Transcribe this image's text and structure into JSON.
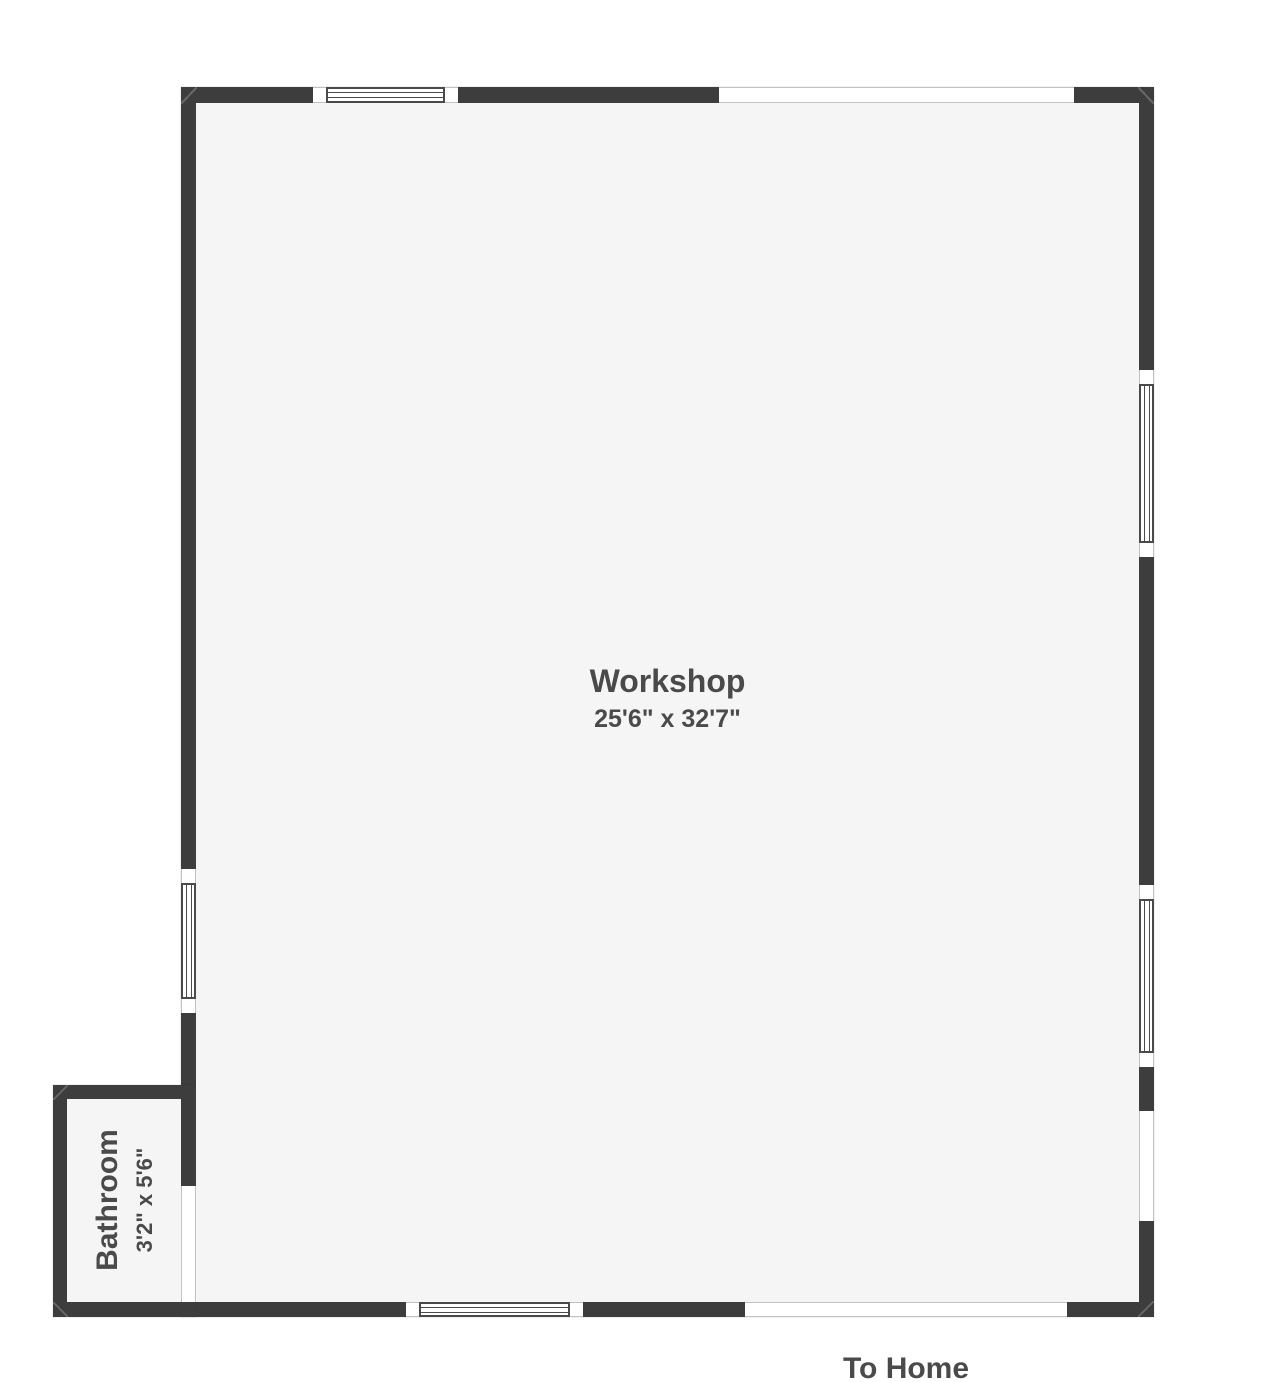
{
  "rooms": [
    {
      "name": "Workshop",
      "dimensions": "25'6\" x 32'7\""
    },
    {
      "name": "Bathroom",
      "dimensions": "3'2\" x 5'6\""
    }
  ],
  "labels": {
    "exit": "To Home"
  },
  "colors": {
    "wall": "#3d3d3d",
    "floor": "#f5f5f5",
    "background": "#ffffff",
    "text": "#4a4a4a",
    "window_frame": "#4a4a4a",
    "opening_outline": "#c2c2c2"
  }
}
